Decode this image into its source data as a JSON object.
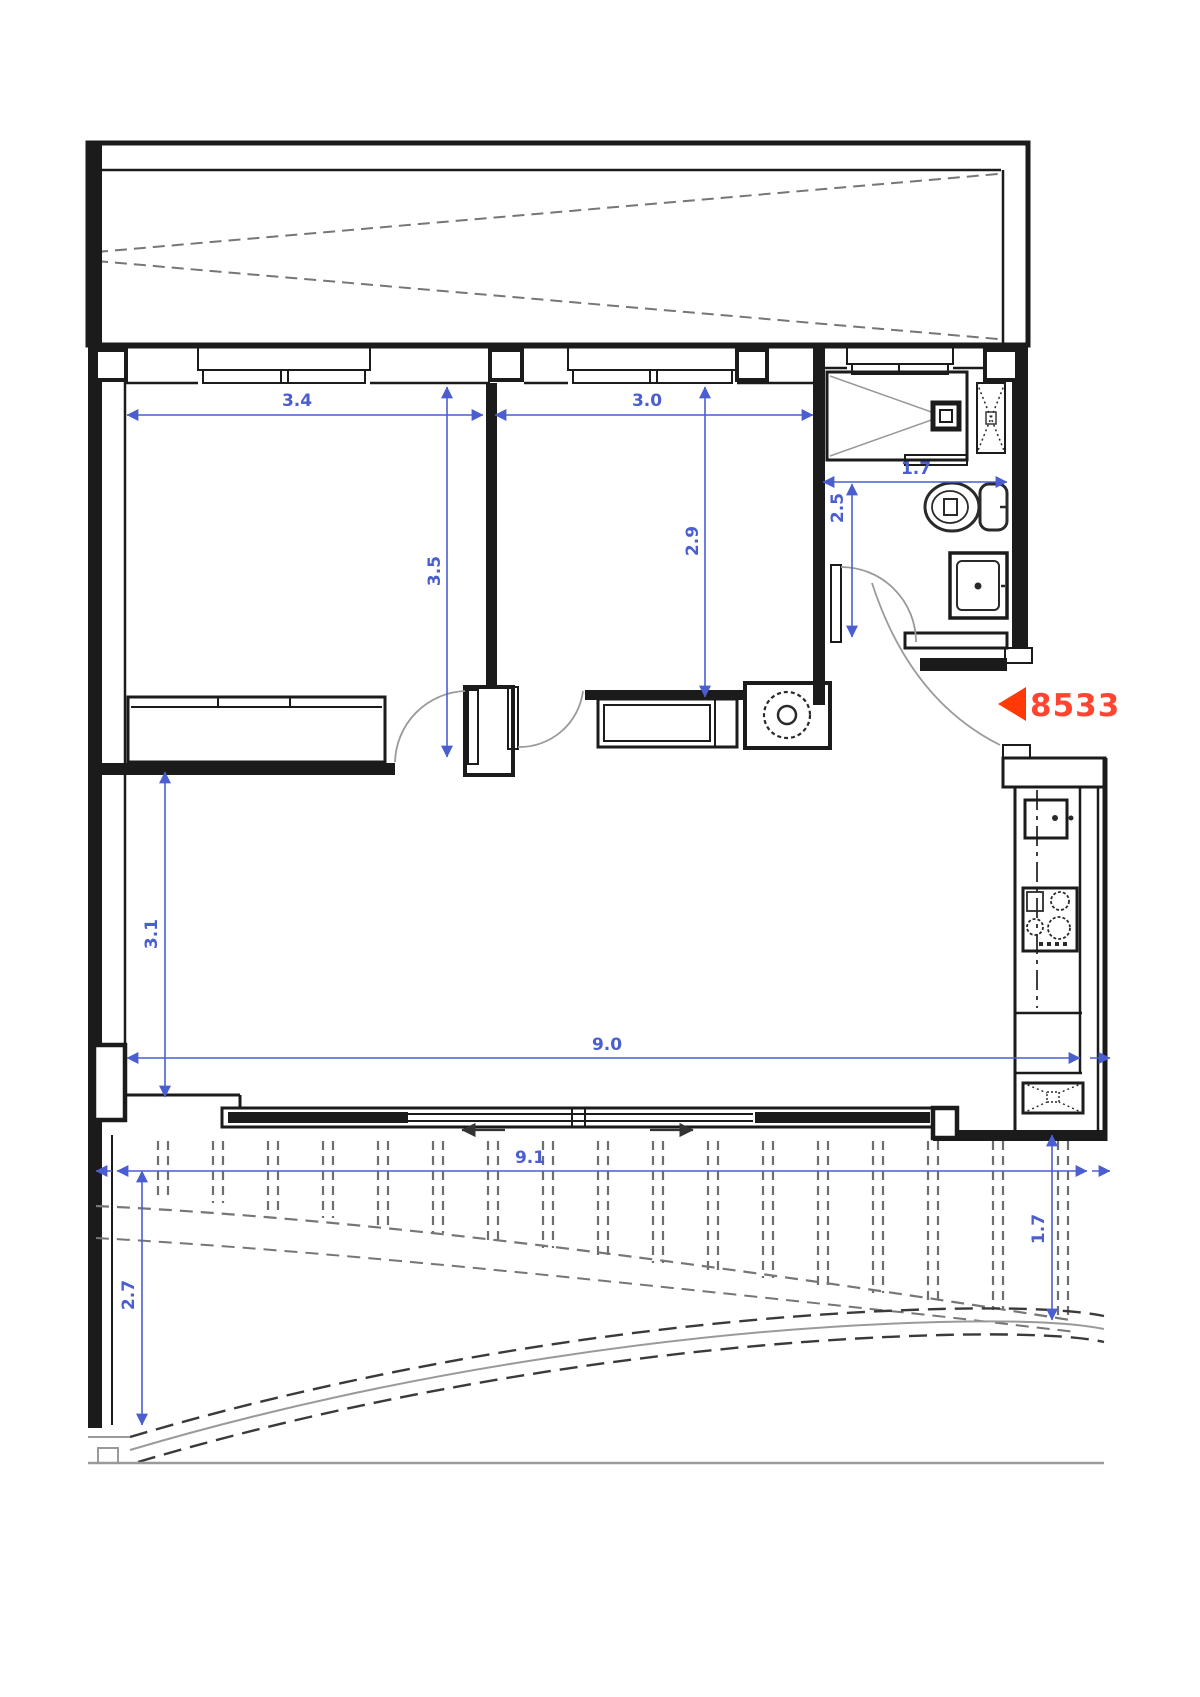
{
  "page": {
    "kind": "architectural floor plan",
    "background": "#ffffff"
  },
  "colors": {
    "wall": "#1b1b1b",
    "dimension_blue": "#4a5ed0",
    "dashed_gray": "#767676",
    "site_gray": "#9a9a9a",
    "marker_red": "#ff3a06"
  },
  "dimensions": {
    "bedroom1_width": "3.4",
    "bedroom1_depth": "3.5",
    "bedroom2_width": "3.0",
    "bedroom2_depth": "2.9",
    "bath_width": "1.7",
    "bath_depth": "2.5",
    "living_depth": "3.1",
    "living_width": "9.0",
    "terrace_width": "9.1",
    "terrace_depth_left": "2.7",
    "terrace_depth_right": "1.7"
  },
  "marker": {
    "unit_label": "8533"
  }
}
